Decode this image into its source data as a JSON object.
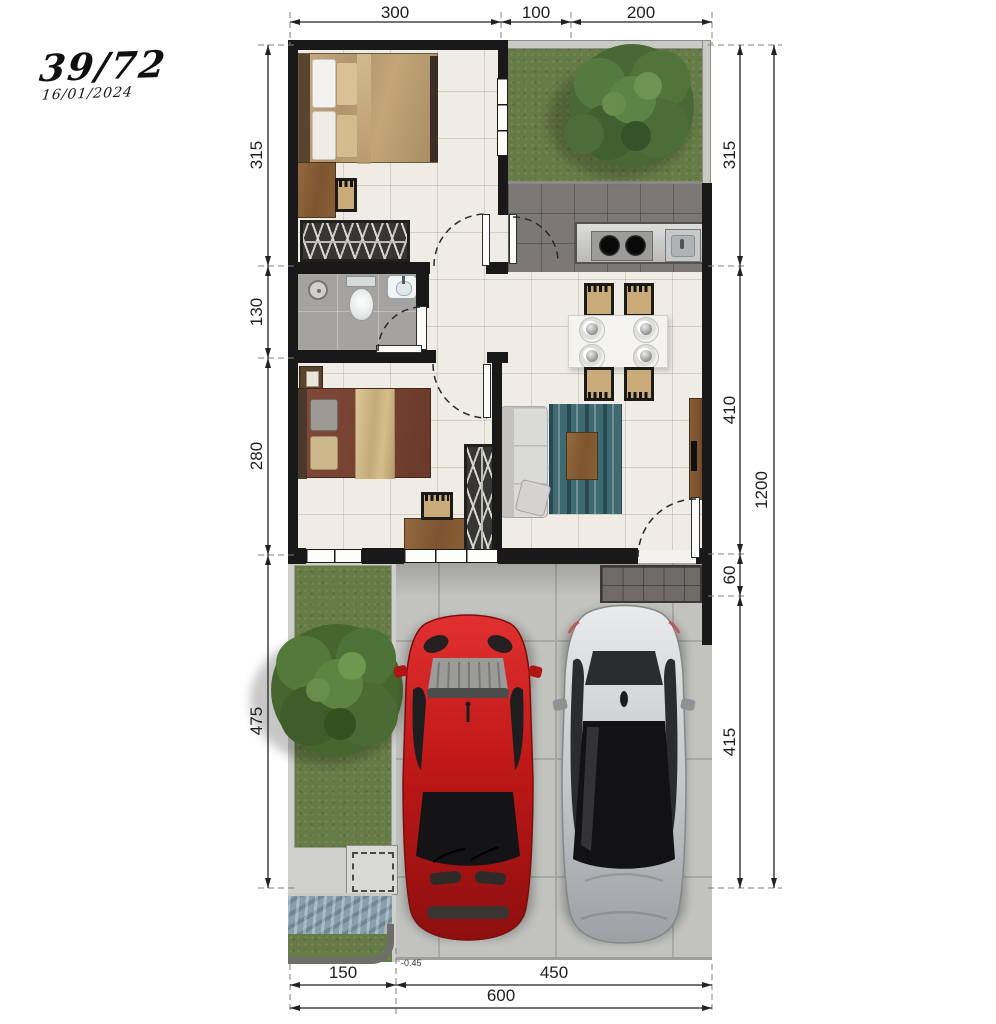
{
  "meta": {
    "title": "39/72",
    "date": "16/01/2024"
  },
  "dimensions": {
    "top": [
      "300",
      "100",
      "200"
    ],
    "left": [
      "315",
      "130",
      "280",
      "475"
    ],
    "right": [
      "315",
      "410",
      "60",
      "415"
    ],
    "right_total": "1200",
    "bottom": [
      "150",
      "450"
    ],
    "bottom_total": "600",
    "level_marker": "-0.45"
  },
  "palette": {
    "wall": "#191919",
    "floor_tile": "#eeece4",
    "bathroom_floor": "#a4a3a0",
    "kitchen_floor": "#7c7974",
    "grass": "#667c46",
    "carport_concrete": "#c2c3bf",
    "entry_terrace": "#6f6c67",
    "pond_water": "#87a0ac",
    "rug": "#3f6a72",
    "car_red": "#c01818",
    "car_silver": "#c6c8ca",
    "wood": "#8a5f3a"
  },
  "elements": [
    "master-bedroom",
    "garden",
    "kitchen",
    "bathroom",
    "second-bedroom",
    "dining-area",
    "living-room",
    "entry-terrace",
    "front-yard",
    "pond",
    "carport",
    "red-car",
    "silver-car",
    "trees"
  ]
}
